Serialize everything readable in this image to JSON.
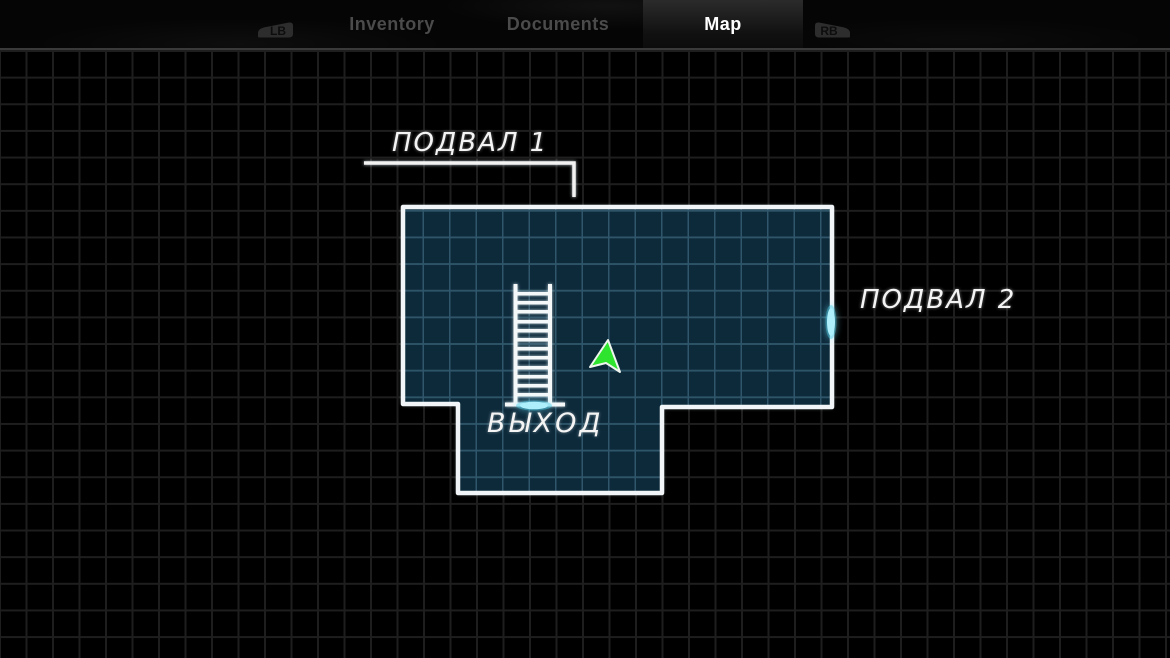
{
  "header": {
    "lb_button": "LB",
    "rb_button": "RB",
    "tabs": [
      {
        "label": "Inventory",
        "active": false
      },
      {
        "label": "Documents",
        "active": false
      },
      {
        "label": "Map",
        "active": true
      }
    ]
  },
  "map": {
    "room_labels": {
      "basement1": "ПОДВАЛ 1",
      "basement2": "ПОДВАЛ 2",
      "exit": "ВЫХОД"
    },
    "markers": {
      "ladder": "ladder-icon",
      "exit_door": "exit-door-marker",
      "basement2_door": "basement2-door-marker",
      "player": "player-arrow-icon"
    },
    "colors": {
      "room_fill": "#07293a",
      "room_grid": "#2f566a",
      "wall": "#f1f5f7",
      "door_glow": "#aeeffc",
      "player_arrow": "#2fe42f",
      "background_grid": "#1e1e1e"
    }
  }
}
